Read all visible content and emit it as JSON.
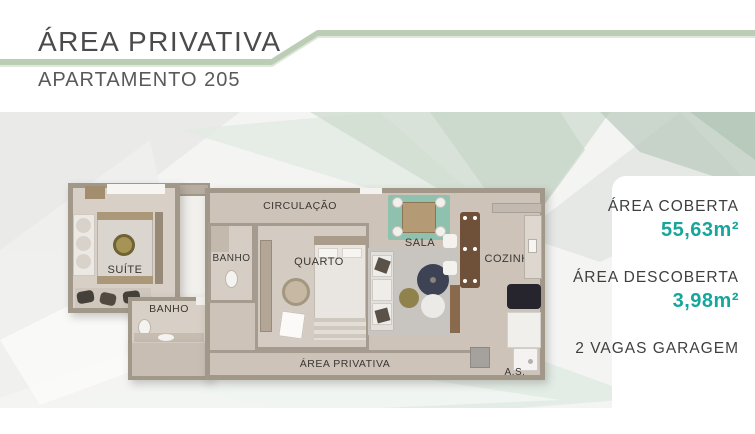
{
  "header": {
    "title": "ÁREA PRIVATIVA",
    "subtitle": "APARTAMENTO 205"
  },
  "colors": {
    "accent_teal": "#17a69b",
    "line_green": "#bccdb6",
    "wall": "#a29889"
  },
  "floorplan": {
    "labels": {
      "suite": "SUÍTE",
      "banho_suite": "BANHO",
      "banho_social": "BANHO",
      "circulacao": "CIRCULAÇÃO",
      "quarto": "QUARTO",
      "sala": "SALA",
      "cozinha": "COZINHA",
      "area_privativa": "ÁREA PRIVATIVA",
      "area_servico": "A.S."
    }
  },
  "info_panel": {
    "items": [
      {
        "label": "ÁREA COBERTA",
        "value": "55,63m²"
      },
      {
        "label": "ÁREA DESCOBERTA",
        "value": "3,98m²"
      },
      {
        "label": "2 VAGAS GARAGEM",
        "value": ""
      }
    ]
  }
}
